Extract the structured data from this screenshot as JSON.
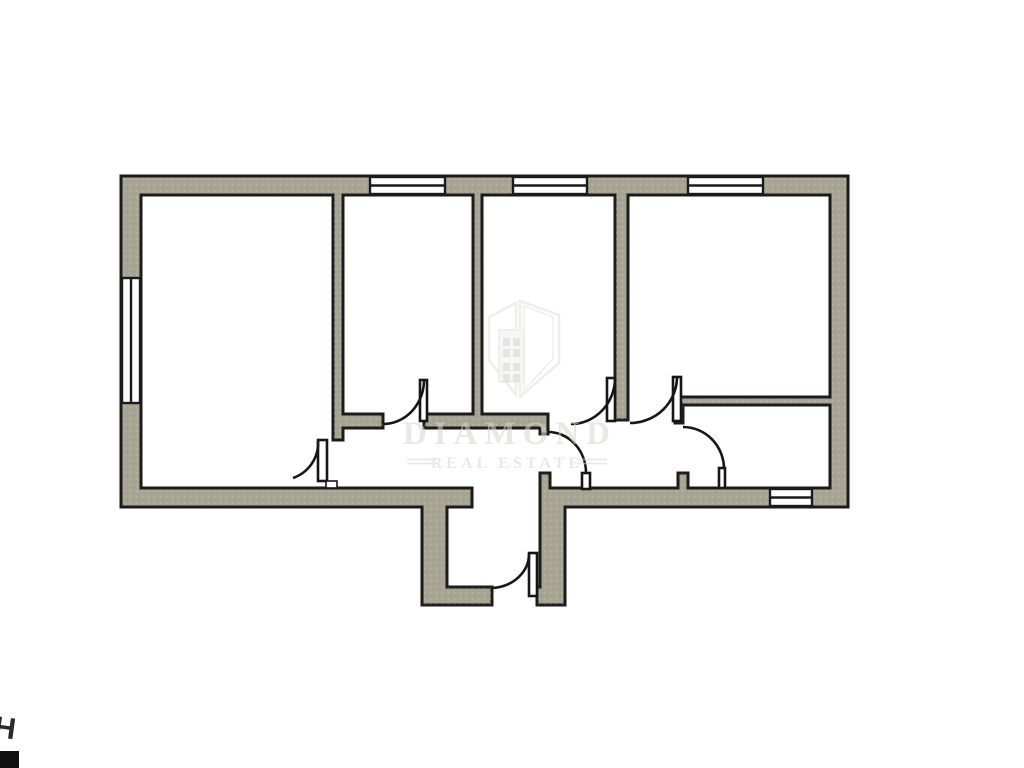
{
  "image": {
    "type": "architectural floor plan",
    "background": "#ffffff"
  },
  "watermark": {
    "brand": "DIAMOND",
    "tagline": "REAL ESTATE"
  },
  "corner_fragment": {
    "text": "H"
  },
  "colors": {
    "wall_fill": "#a9a594",
    "outline": "#1b1b1b",
    "floor": "#ffffff",
    "watermark_text": "#d7d7d3",
    "watermark_logo": "#dededa",
    "logo_window": "#c9c9c5"
  }
}
